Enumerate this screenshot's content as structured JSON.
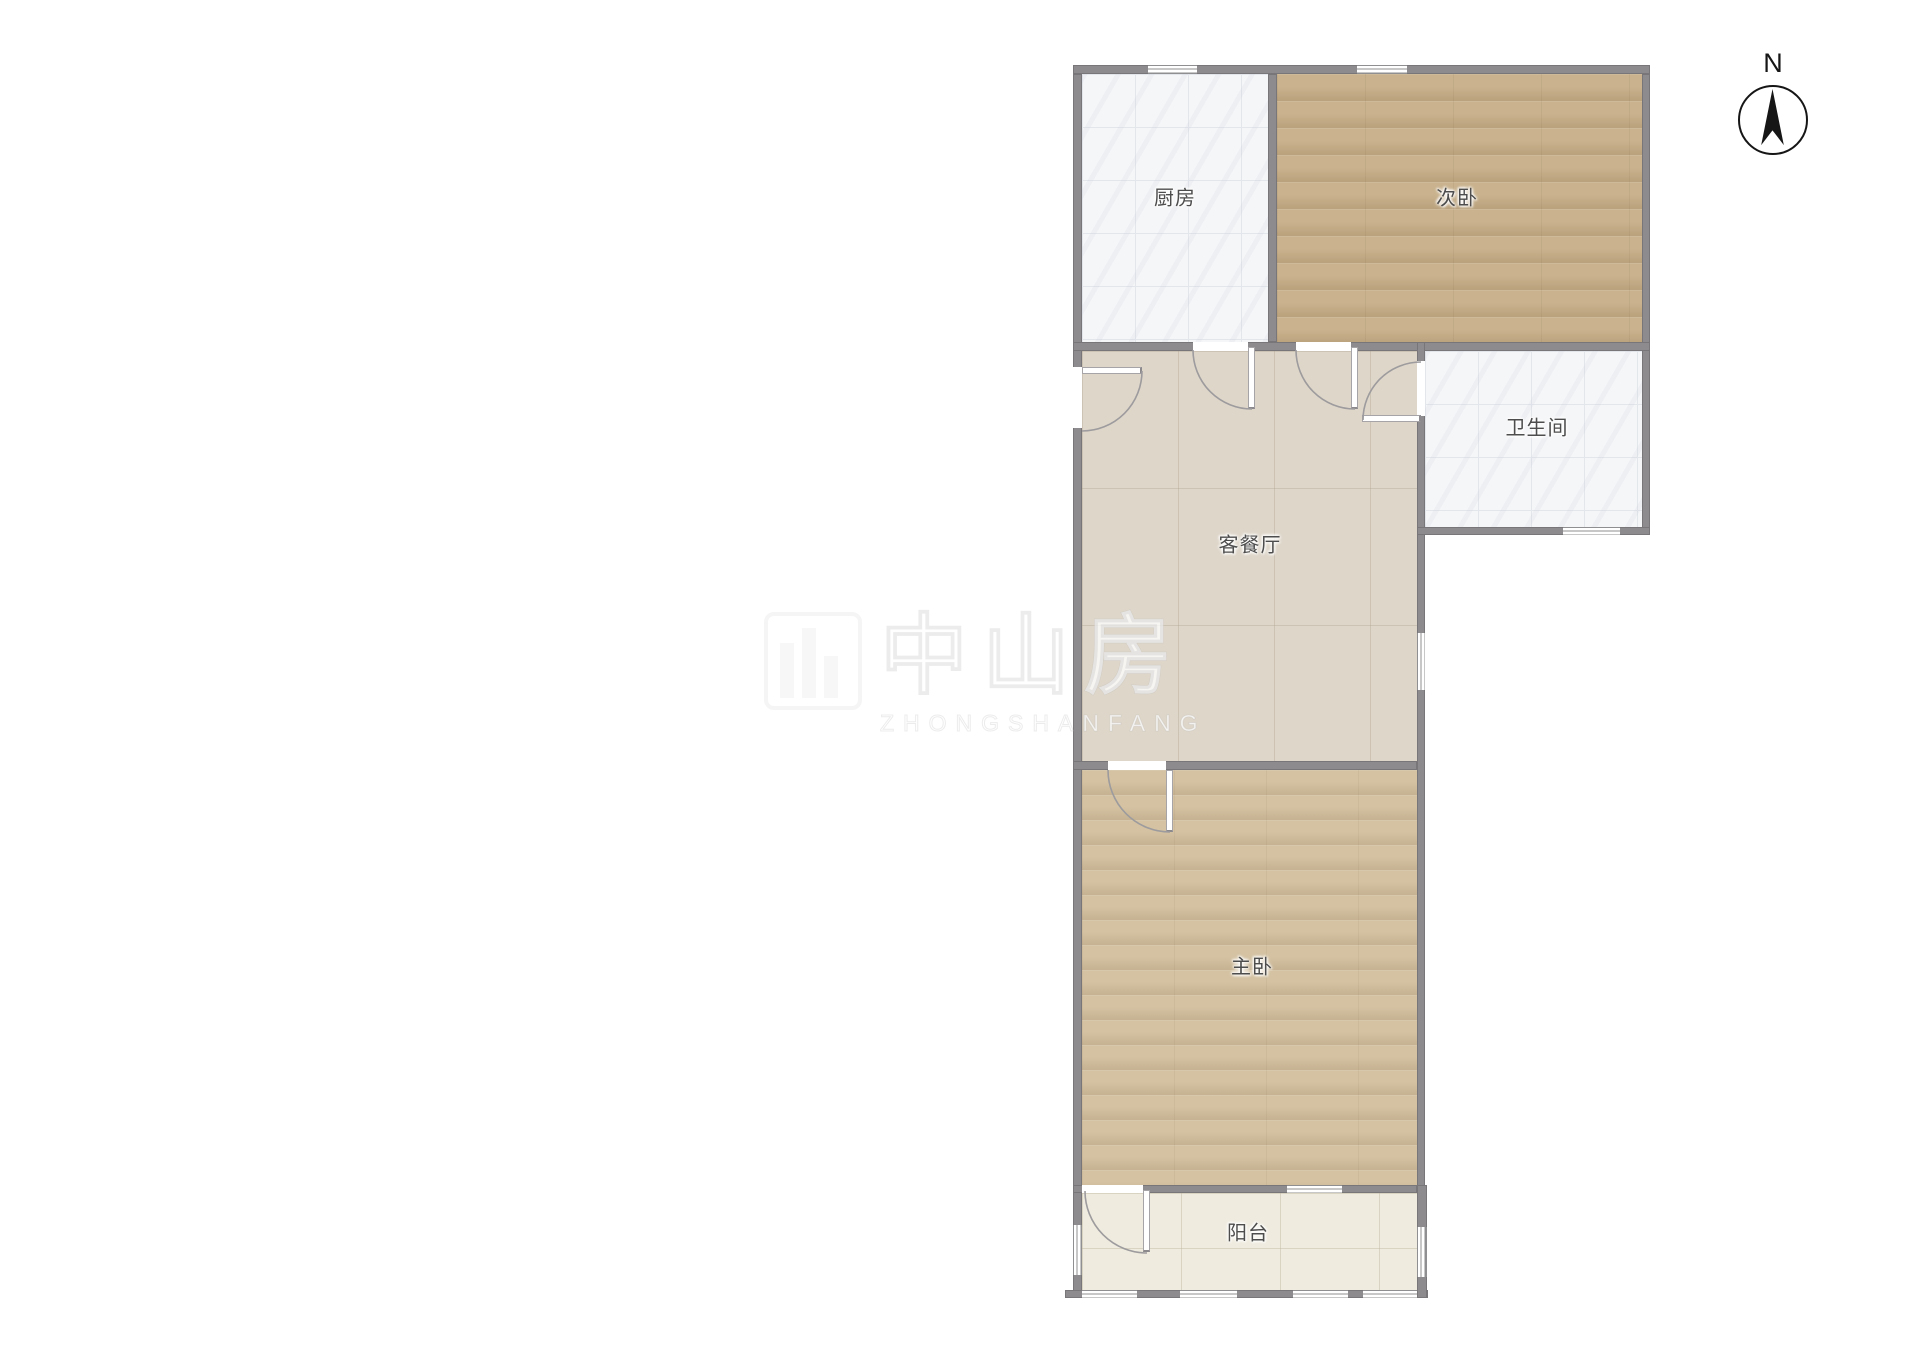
{
  "plan_title": "floor-plan",
  "compass": {
    "north_label": "N"
  },
  "rooms": [
    {
      "id": "kitchen",
      "label": "厨房"
    },
    {
      "id": "bedroom-second",
      "label": "次卧"
    },
    {
      "id": "bathroom",
      "label": "卫生间"
    },
    {
      "id": "living-dining",
      "label": "客餐厅"
    },
    {
      "id": "bedroom-master",
      "label": "主卧"
    },
    {
      "id": "balcony",
      "label": "阳台"
    }
  ],
  "watermark": {
    "cn": "中山房",
    "en": "ZHONGSHANFANG"
  },
  "colors": {
    "wall": "#8d8b8e",
    "tile": "#f5f6f8",
    "wood2": "#c9b28d",
    "wood1": "#d4c2a2",
    "living": "#ded6c9",
    "balcony": "#efebdf",
    "label": "#4d4d4d"
  }
}
